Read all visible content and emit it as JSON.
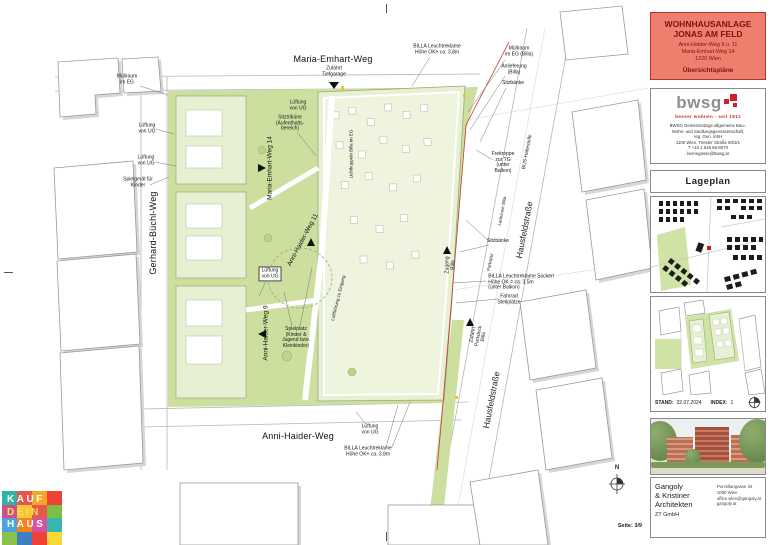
{
  "colors": {
    "title_bg": "#ef7e6f",
    "title_text": "#7d130d",
    "bwsg_red": "#c2272d",
    "site_green": "#ccdf9f",
    "building_green": "#e7f0d2",
    "boundary_red": "#c23a2e"
  },
  "title_block": {
    "line1": "WOHNHAUSANLAGE",
    "line2": "JONAS AM FELD",
    "address1": "Anni-Haider-Weg 9 u. 11",
    "address2": "Maria-Emhart-Weg 14",
    "address3": "1220 Wien",
    "subtitle": "Übersichtspläne"
  },
  "bwsg": {
    "word": "bwsg",
    "tagline": "besser wohnen - seit 1911",
    "lines": [
      "BWSG Gemeinnützige allgemeine Bau-,",
      "Wohn- und Siedlungsgenossenschaft,",
      "reg. Gen. mbH",
      "1100 Wien, Triester Straße 60/3/1",
      "T +43 1 546 66-5070",
      "bernegasse@bwsg.at"
    ]
  },
  "lageplan": {
    "title": "Lageplan"
  },
  "stand": {
    "label1": "STAND:",
    "value1": "22.07.2024",
    "label2": "INDEX:",
    "value2": "1"
  },
  "architect": {
    "name_lines": [
      "Gangoly",
      "& Kristiner",
      "Architekten"
    ],
    "suffix": "ZT GmbH",
    "contact": [
      "Porzellangasse 34",
      "1090 Wien",
      "office.wien@gangoly.at",
      "gangoly.at"
    ]
  },
  "plan": {
    "north": "N",
    "page": "Seite: 3/9",
    "streets": {
      "maria_emhart": "Maria-Emhart-Weg",
      "gerhard_buechl": "Gerhard-Büchl-Weg",
      "anni_haider": "Anni-Haider-Weg",
      "hausfeld": "Hausfeldstraße"
    },
    "buildings": {
      "mew14": "Maria-Emhart-Weg 14",
      "ahw11": "Anni-Haider-Weg 11",
      "ahw9": "Anni-Haider-Weg 9"
    },
    "annotations": {
      "muellraum_eg": "Müllraum\nim EG",
      "zufahrt_tiefgarage": "Zufahrt\nTiefgarage",
      "billa_reklame_top": "BILLA Leuchtreklame\nHöhe OK+ ca. 3,8m",
      "muellraum_billa": "Müllraum\nim EG (Billa)",
      "anlieferung_billa": "Anlieferung\n(Billa)",
      "sitzbaenke_1": "Sitzbänke",
      "freitreppe": "Freitreppe\nzur TG\n(unter\nBalkon)",
      "bus_haltestelle": "BUS-Haltestelle",
      "ladezone_billa": "Ladezone Billa",
      "parkspur": "Parkspur",
      "sitzbaenke_2": "Sitzbänke",
      "zugang_billa": "Zugang\nBilla",
      "billa_sockerl": "BILLA Leuchtreklame Sockerl\nHöhe OK = ca. 3,5m\n(unter Balkon)",
      "fahrrad": "Fahrrad\nStellplätze",
      "zufahrt_parkdeck": "Zufahrt\nParkdeck\nBilla",
      "lueftung_a": "Lüftung\nvon UG",
      "lueftung_b": "Lüftung\nvon UG",
      "lueftung_c": "Lüftung\nvon UG",
      "lueftung_d": "Lüftung\nvon UG",
      "lueftung_e": "Lüftung\nvon UG",
      "spielgeraet": "Spielgerät für\nKinder",
      "sitztribuene": "Sitztribüne\n(Aufenthalts-\nbereich)",
      "lichtkuppeln": "Lichtkuppeln Billa im EG",
      "spielplatz": "Spielplatz\n(Kinder &\nJugend bzw.\nKleinkinder)",
      "luftfuehrung": "Luftführung zu Eingang",
      "billa_reklame_bottom": "BILLA Leuchtreklame\nHöhe OK+ ca. 3,8m"
    }
  },
  "kdh": {
    "lines": [
      "KAUF",
      "DEIN",
      "HAUS"
    ]
  }
}
